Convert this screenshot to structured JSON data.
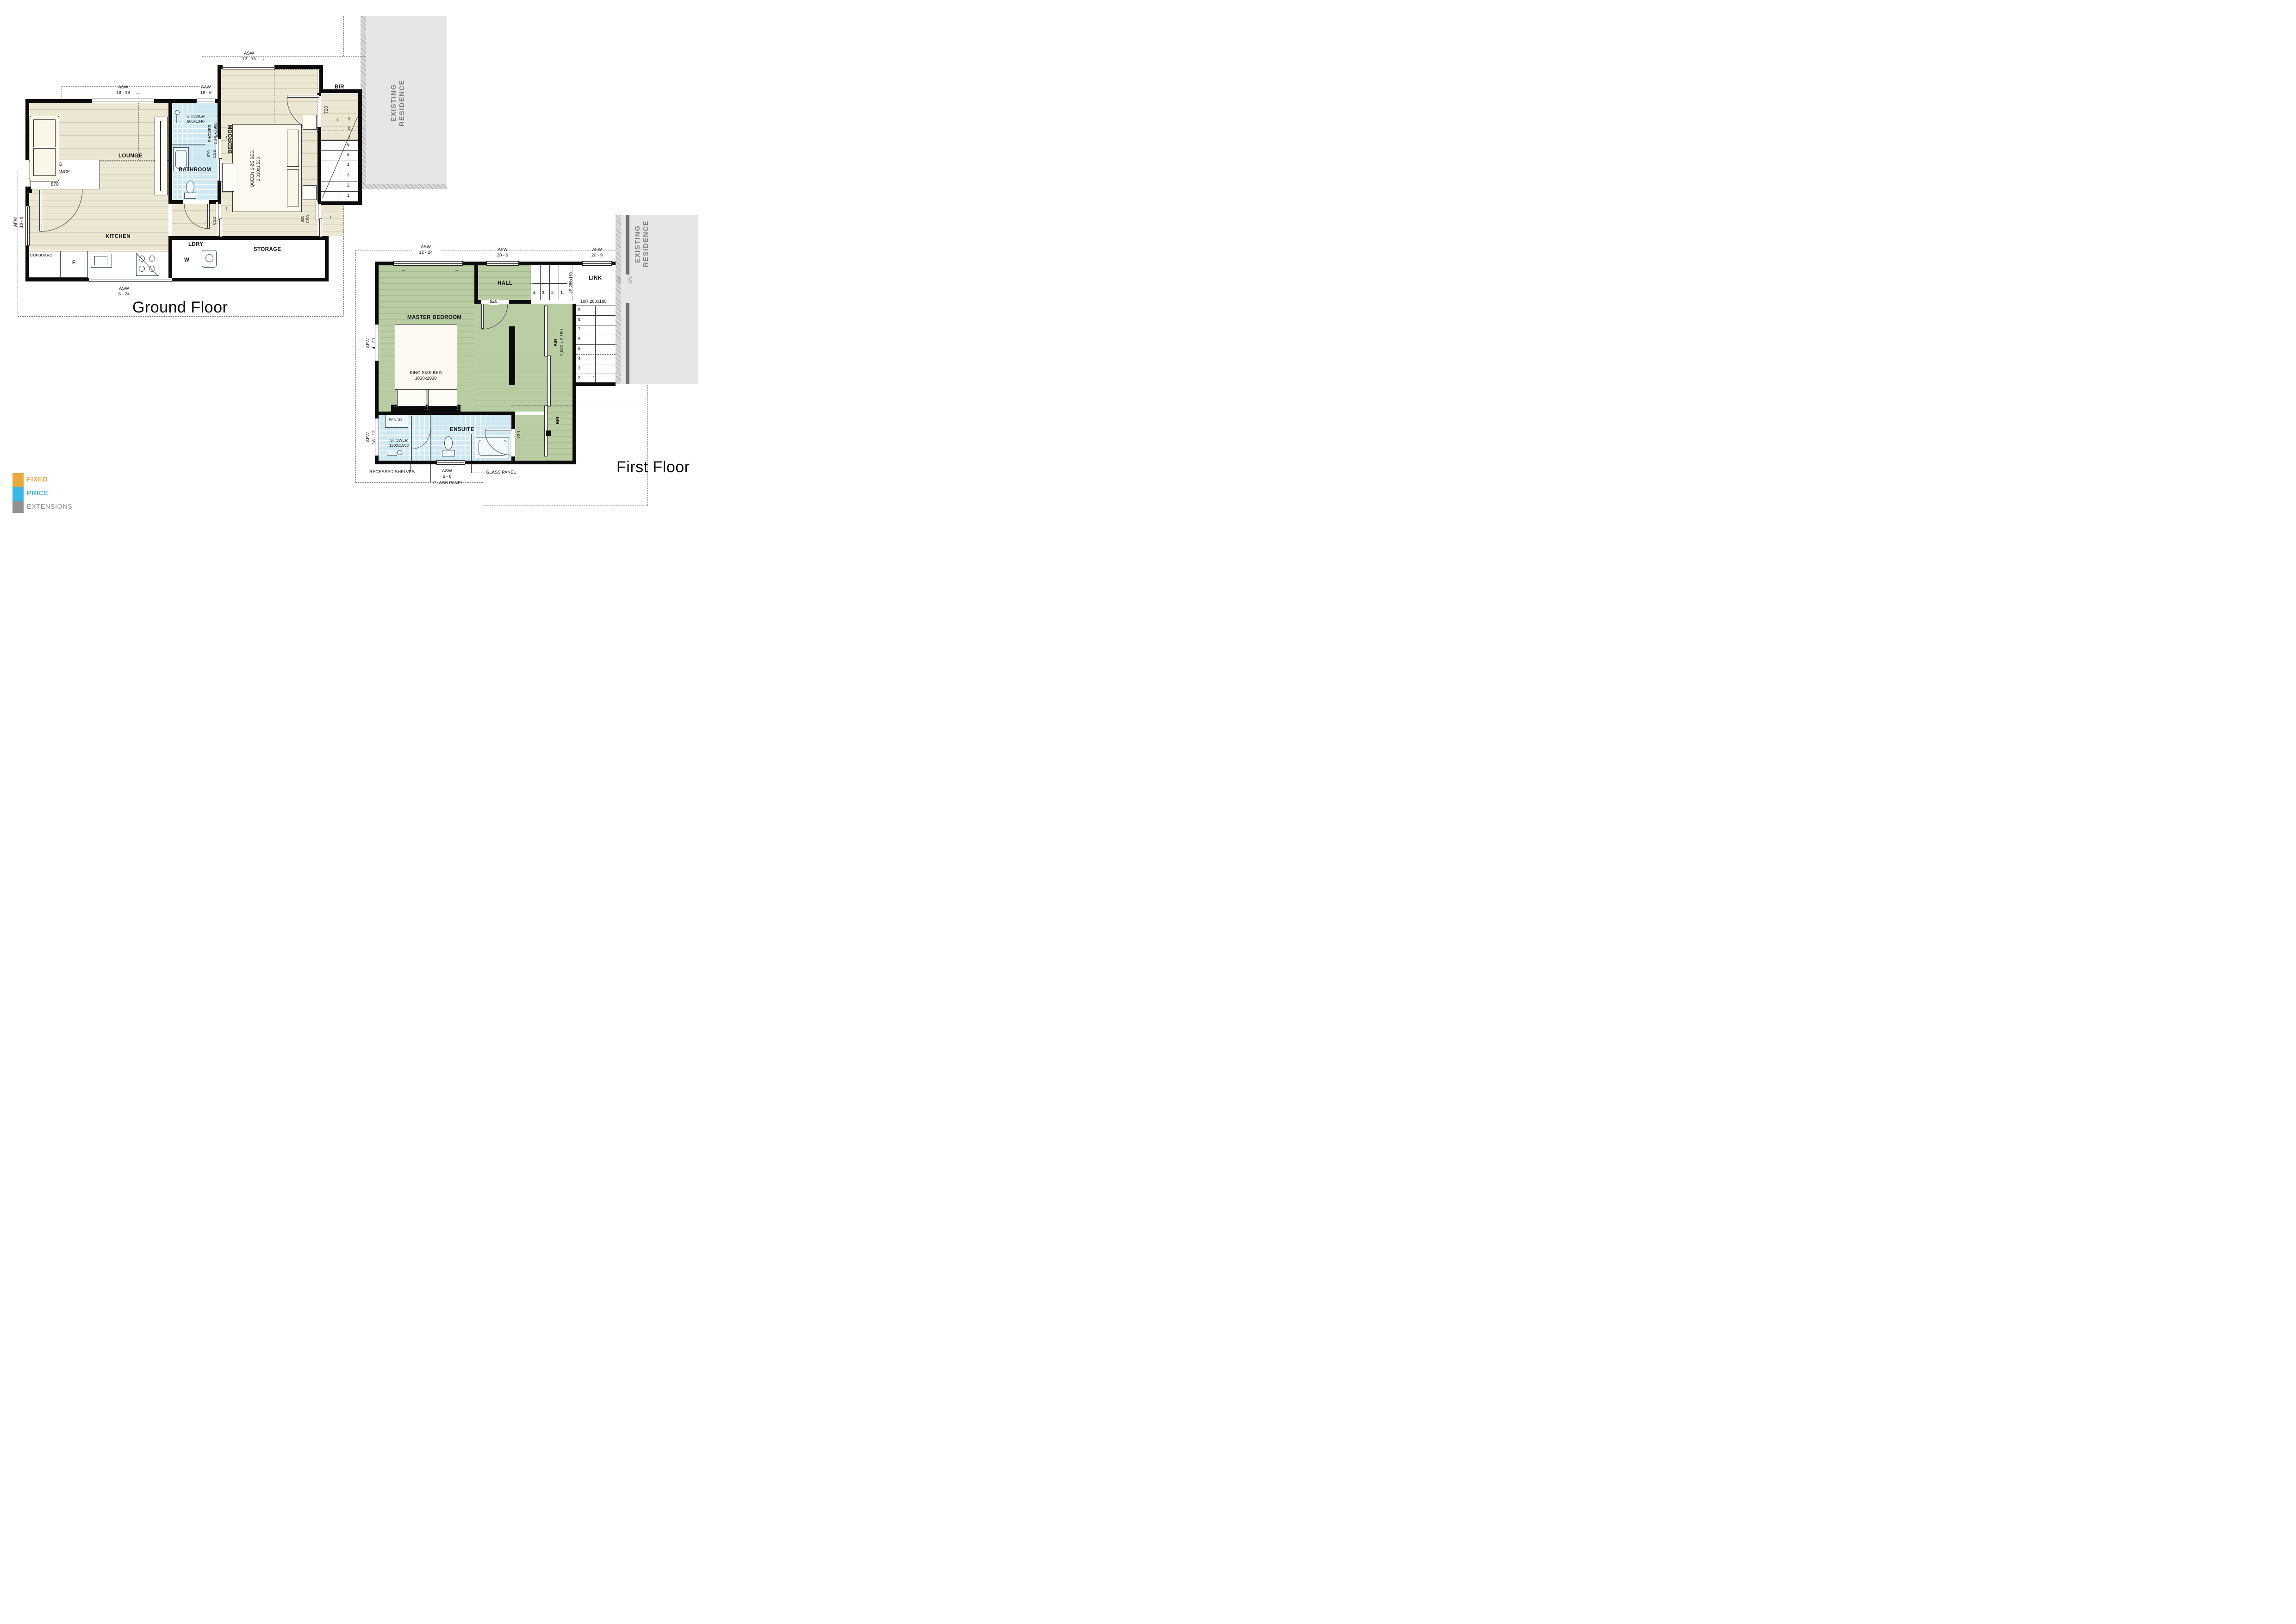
{
  "icons": {
    "arrow_left": "←",
    "arrow_right": "→",
    "arrow_up": "↑",
    "arrow_down": "↓",
    "triangle_down": "▽"
  },
  "logo": {
    "line1": "FIXED",
    "line2": "PRICE",
    "line3": "EXTENSIONS",
    "color1": "#EAA73D",
    "color2": "#3AB7EA",
    "color3": "#8F9193"
  },
  "ground": {
    "title": "Ground Floor",
    "existing_residence_line1": "EXISTING",
    "existing_residence_line2": "RESIDENCE",
    "rooms": {
      "lounge": "LOUNGE",
      "kitchen": "KITCHEN",
      "bathroom": "BATHROOM",
      "bedroom": "BEDROOM",
      "bir": "BIR",
      "storage": "STORAGE",
      "ldry": "LDRY",
      "landing": "LANDING",
      "cupboard": "CUPBOARD"
    },
    "windows": {
      "asw1818": {
        "code": "ASW",
        "size": "18 - 18"
      },
      "aaw186": {
        "code": "AAW",
        "size": "18 - 6"
      },
      "asw1215": {
        "code": "ASW",
        "size": "12 - 15"
      },
      "afw188": {
        "code": "AFW",
        "size": "18 - 8"
      },
      "asw624": {
        "code": "ASW",
        "size": "6 - 24"
      }
    },
    "doors": {
      "bir_width": "720",
      "entrance": "ENTRANCE",
      "entrance_width": "870",
      "bath_csd_w": "870",
      "bath_csd_t": "CSD",
      "hall_csd_w": "870",
      "hall_csd_t": "CSD",
      "bed_csd_w": "920",
      "bed_csd_t": "CSD"
    },
    "fixtures": {
      "shower_label": "SHOWER",
      "shower_size": "900x1340",
      "shower_v1": "SHOWER",
      "shower_v2": "1.340x0.900",
      "fridge": "F",
      "washer": "W",
      "queen_bed_1": "QUEEN SIZE BED",
      "queen_bed_2": "2.030x1.530"
    },
    "stairs": {
      "upper": [
        "9.",
        "8.",
        "7."
      ],
      "lower": [
        "6.",
        "5.",
        "4.",
        "3.",
        "2.",
        "1."
      ]
    }
  },
  "first": {
    "title": "First Floor",
    "existing_residence_line1": "EXISTING",
    "existing_residence_line2": "RESIDENCE",
    "rooms": {
      "master": "MASTER BEDROOM",
      "hall": "HALL",
      "link": "LINK",
      "ensuite": "ENSUITE",
      "bir": "BIR",
      "bir2": "BIR"
    },
    "windows": {
      "afw209L": {
        "code": "AFW",
        "size": "20 - 9"
      },
      "afw209R": {
        "code": "AFW",
        "size": "20 - 9"
      },
      "asw1224": {
        "code": "ASW",
        "size": "12 - 24"
      },
      "afw420": {
        "code": "AFW",
        "size": "4 - 20"
      },
      "afw1812": {
        "code": "AFW",
        "size": "18 - 12"
      },
      "asw68": {
        "code": "ASW",
        "size": "6 - 8"
      }
    },
    "doors": {
      "hall_door": "820",
      "ensuite_door": "720"
    },
    "dims": {
      "link_offset1": "875",
      "link_offset2": "875",
      "bir_size": "2,060 x 2,150"
    },
    "stairs": {
      "r4_label": "4R 280x180",
      "r4": [
        "4.",
        "3.",
        "2.",
        "1."
      ],
      "r10_label": "10R 280x180",
      "r10": [
        "9.",
        "8.",
        "7.",
        "6.",
        "5.",
        "4.",
        "3.",
        "2."
      ]
    },
    "fixtures": {
      "bench": "BENCH",
      "king_1": "KING SIZE BED",
      "king_2": "1830x2030",
      "shower_1": "SHOWER",
      "shower_2": "1300x1500"
    },
    "annotations": {
      "recessed": "RECESSED SHELVES",
      "glass1": "GLASS PANEL",
      "glass2": "GLASS PANEL"
    }
  }
}
